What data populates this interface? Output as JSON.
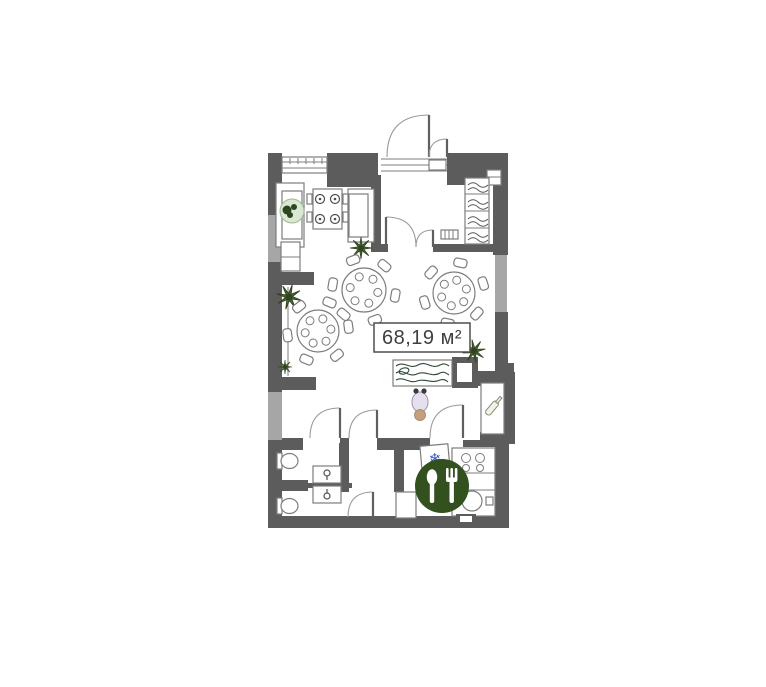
{
  "plan": {
    "area_label": "68,19 м²"
  },
  "icons": {
    "snowflake_glyph": "❄",
    "restaurant_icon": "spoon-and-fork-badge",
    "bottle_icon": "bottle",
    "plant_icon": "potted-plant",
    "hanger_icon": "wardrobe-clothes-rail",
    "figurine_icon": "decor-figurine",
    "toilet_icon": "toilet",
    "sink_icon": "washbasin",
    "stove_icon": "four-burner-stove",
    "fridge_icon": "refrigerator"
  },
  "colors": {
    "wall": "#5c5c5c",
    "wall_light": "#a6a6a6",
    "line": "#7d7d7d",
    "line_dark": "#4f4f4f",
    "plant_green": "#4a6632",
    "plant_dark": "#2f4420",
    "badge_green": "#33511f",
    "snowflake_blue": "#3a57c9",
    "hatch_green": "#2e4a33",
    "label_text": "#3f3f3f",
    "pouf_green": "#d9e8d2",
    "figurine_lavender": "#e6e0ee",
    "figurine_base": "#c69f7e"
  }
}
